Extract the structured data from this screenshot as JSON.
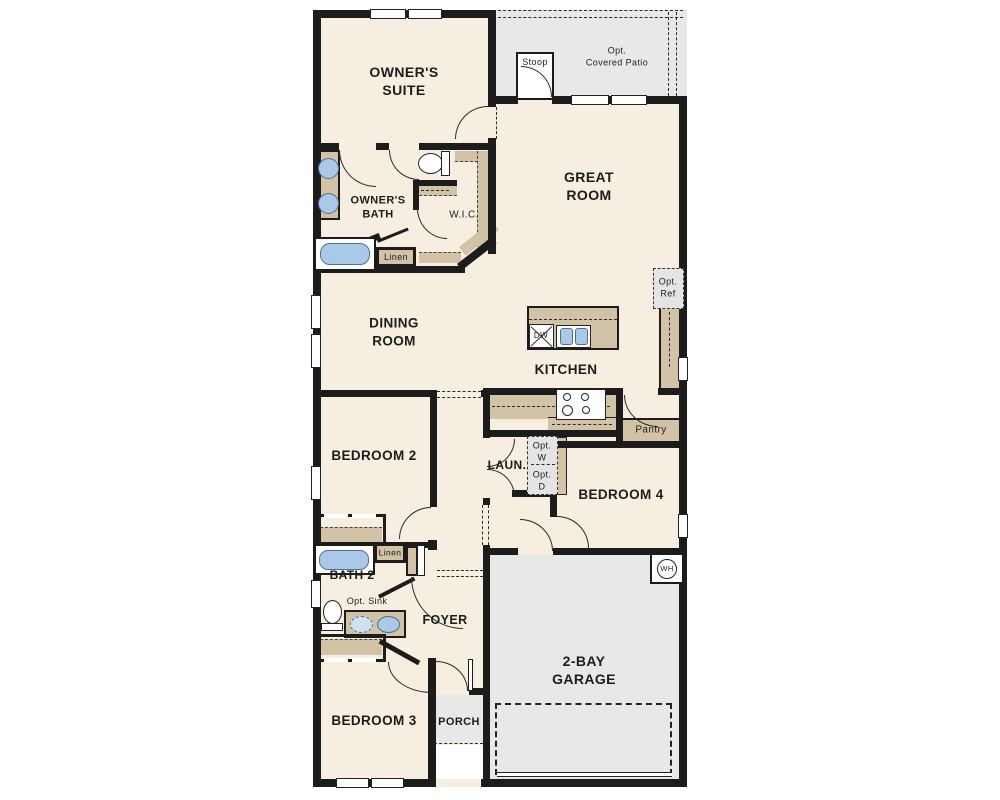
{
  "rooms": {
    "owners_suite": "OWNER'S\nSUITE",
    "owners_bath": "OWNER'S\nBATH",
    "wic": "W.I.C.",
    "great_room": "GREAT\nROOM",
    "dining_room": "DINING\nROOM",
    "kitchen": "KITCHEN",
    "bedroom2": "BEDROOM 2",
    "bedroom3": "BEDROOM 3",
    "bedroom4": "BEDROOM 4",
    "bath2": "BATH 2",
    "laundry": "LAUN.",
    "foyer": "FOYER",
    "porch": "PORCH",
    "garage": "2-BAY\nGARAGE",
    "stoop": "Stoop",
    "covered_patio": "Opt.\nCovered Patio",
    "pantry": "Pantry"
  },
  "fixtures": {
    "linen_owners": "Linen",
    "linen_bath2": "Linen",
    "dishwasher": "DW",
    "opt_ref": "Opt.\nRef",
    "opt_washer": "Opt.\nW",
    "opt_dryer": "Opt.\nD",
    "opt_sink": "Opt. Sink",
    "water_heater": "WH"
  },
  "colors": {
    "floor": "#f6eee1",
    "optional_area_gray": "#e8e8e6",
    "cabinetry_tan": "#d2c3a7",
    "fixture_blue": "#aac9e8",
    "wall_black": "#1c1c1c"
  }
}
